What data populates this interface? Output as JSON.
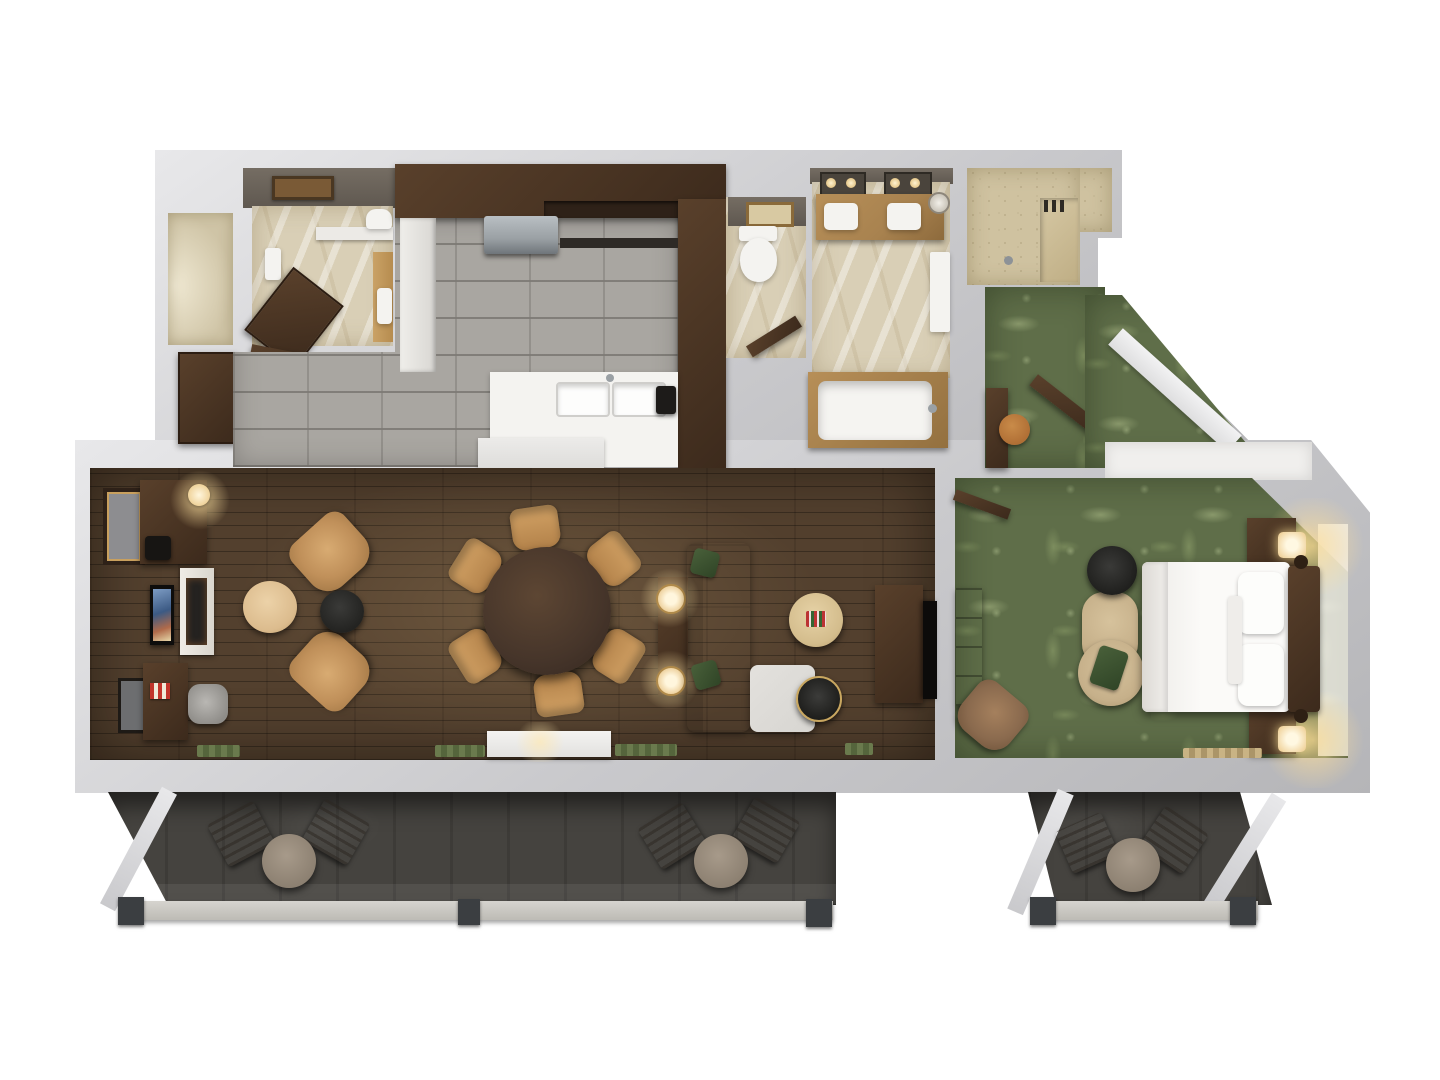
{
  "scene": {
    "title": "3D top-down floor plan render of a one-bedroom hotel suite with lanais",
    "view": "overhead dollhouse 3D render",
    "no_visible_text": true
  },
  "palette": {
    "bg": "#ffffff",
    "wall": "#c9c9cc",
    "wall-light": "#e8e8ea",
    "wall-dark": "#b5b5b8",
    "floor-wood": "#53402e",
    "carpet": "#5f6e49",
    "tile": "#a9a6a1",
    "marble": "#d9cfb6",
    "speckle": "#cfc2a0",
    "espresso": "#3c2a1c",
    "espresso-light": "#59402b",
    "tan-chair": "#c0905a",
    "sofa": "#d7d5d1",
    "granite": "#a8824f",
    "concrete": "#45433f",
    "railing": "#bdbbb5",
    "post": "#3b3e41",
    "glow": "#ffdf9e",
    "white-floor": "#f0efed",
    "mat-green": "#6a7a4d",
    "pouf": "#dcbc8e",
    "black-table": "#232321",
    "orange-stool": "#b06f35",
    "chaise": "#c6b08a",
    "steel": "#9aa0a4",
    "tub-white": "#f5f4f1"
  },
  "rooms": [
    {
      "name": "kitchen",
      "floor": "gray subway tile",
      "features": [
        "espresso L-shaped cabinets",
        "stainless dishwasher",
        "double sink counter",
        "island peninsula"
      ]
    },
    {
      "name": "guest-bathroom",
      "floor": "beige marble",
      "features": [
        "open espresso door",
        "vanity",
        "toilet nook"
      ]
    },
    {
      "name": "closet",
      "floor": "beige",
      "features": []
    },
    {
      "name": "powder-room",
      "floor": "beige marble",
      "features": [
        "toilet",
        "open door"
      ]
    },
    {
      "name": "master-bathroom",
      "floor": "beige marble",
      "features": [
        "double vanity with mirrors",
        "soaking tub"
      ]
    },
    {
      "name": "walk-in-shower",
      "floor": "speckled travertine",
      "features": [
        "bench",
        "shower head"
      ]
    },
    {
      "name": "entry-foyer",
      "floor": "green palm-print carpet",
      "features": [
        "open entry door",
        "writing desk",
        "round stool",
        "diagonal hallway"
      ]
    },
    {
      "name": "living-dining-room",
      "floor": "dark hardwood plank",
      "features": [
        "fireplace with TV",
        "wet bar",
        "work desk",
        "round dining table for six",
        "L-sectional sofa",
        "media console"
      ]
    },
    {
      "name": "bedroom",
      "floor": "green palm-print carpet",
      "features": [
        "king bed",
        "two lit nightstand lamps",
        "dresser",
        "corner TV",
        "wicker chaise",
        "armchair"
      ]
    },
    {
      "name": "main-lanai",
      "floor": "dark concrete",
      "features": [
        "two bistro sets",
        "gray railing",
        "dark posts"
      ]
    },
    {
      "name": "bedroom-lanai",
      "floor": "dark concrete",
      "features": [
        "bistro set",
        "gray railing",
        "dark posts"
      ]
    }
  ],
  "furniture_counts": {
    "dining_chairs": 6,
    "lounge_armchairs": 2,
    "balcony_bistro_sets": 3,
    "nightstands": 2,
    "table_lamps_lit": 4
  }
}
